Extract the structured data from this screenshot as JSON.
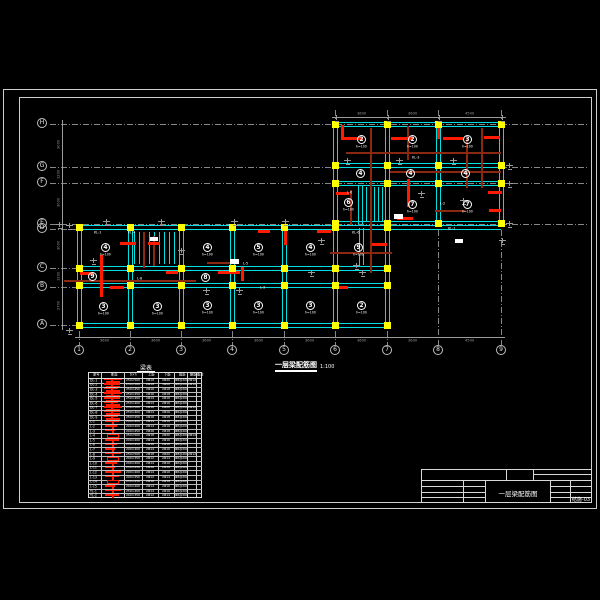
{
  "colors": {
    "cyan": "#00e0e0",
    "yellow": "#ffff00",
    "red": "#ff1a00",
    "maroon": "#8a2812",
    "gray": "#9a9a9a",
    "white": "#ffffff",
    "frame": "#cfcfcf"
  },
  "plan": {
    "title": {
      "text": "一层梁配筋图",
      "scale": "1:100"
    },
    "axes_x": [
      {
        "x": 79,
        "label": "1",
        "ext": 331
      },
      {
        "x": 130,
        "label": "2",
        "ext": 331
      },
      {
        "x": 181,
        "label": "3",
        "ext": 331
      },
      {
        "x": 232,
        "label": "4",
        "ext": 331
      },
      {
        "x": 284,
        "label": "5",
        "ext": 331
      },
      {
        "x": 335,
        "label": "6",
        "ext": 331
      },
      {
        "x": 387,
        "label": "7",
        "ext": 331
      },
      {
        "x": 438,
        "label": "8",
        "ext": 230
      },
      {
        "x": 501,
        "label": "9",
        "ext": 230
      }
    ],
    "axes_y": [
      {
        "y": 124,
        "label": "H",
        "x2": 588
      },
      {
        "y": 167,
        "label": "G",
        "x2": 588
      },
      {
        "y": 183,
        "label": "F",
        "x2": 588
      },
      {
        "y": 224,
        "label": "E",
        "x2": 588
      },
      {
        "y": 229,
        "label": "D",
        "x2": 340
      },
      {
        "y": 268,
        "label": "C",
        "x2": 82
      },
      {
        "y": 287,
        "label": "B",
        "x2": 82
      },
      {
        "y": 325,
        "label": "A",
        "x2": 82
      }
    ],
    "top_stubs": [
      [
        335,
        110,
        14
      ],
      [
        387,
        110,
        14
      ],
      [
        438,
        110,
        14
      ],
      [
        501,
        110,
        14
      ]
    ],
    "beams_h": [
      [
        335,
        124,
        166
      ],
      [
        335,
        165,
        166
      ],
      [
        335,
        183,
        166
      ],
      [
        335,
        223,
        166
      ],
      [
        79,
        227,
        422
      ],
      [
        79,
        268,
        309
      ],
      [
        79,
        285,
        309
      ],
      [
        79,
        325,
        309
      ]
    ],
    "beams_v": [
      [
        79,
        227,
        98
      ],
      [
        130,
        227,
        98
      ],
      [
        181,
        227,
        98
      ],
      [
        232,
        227,
        98
      ],
      [
        284,
        227,
        98
      ],
      [
        335,
        124,
        201
      ],
      [
        387,
        124,
        201
      ],
      [
        438,
        124,
        103
      ],
      [
        501,
        124,
        103
      ]
    ],
    "column_grids": [
      {
        "xs": [
          335,
          387,
          438,
          501
        ],
        "ys": [
          124,
          165,
          183,
          223
        ]
      },
      {
        "xs": [
          79,
          130,
          181,
          232,
          284,
          335,
          387
        ],
        "ys": [
          227,
          268,
          285,
          325
        ]
      }
    ],
    "stairs": [
      [
        357,
        185,
        30,
        "h"
      ],
      [
        358,
        186,
        38,
        "v"
      ],
      [
        362,
        186,
        38,
        "v"
      ],
      [
        366,
        187,
        35,
        "v"
      ],
      [
        370,
        187,
        35,
        "v"
      ],
      [
        374,
        187,
        35,
        "v"
      ],
      [
        378,
        187,
        35,
        "v"
      ],
      [
        382,
        187,
        35,
        "v"
      ],
      [
        359,
        228,
        37,
        "v"
      ],
      [
        363,
        228,
        37,
        "v"
      ],
      [
        134,
        232,
        32,
        "v"
      ],
      [
        139,
        232,
        32,
        "v"
      ],
      [
        144,
        232,
        32,
        "v"
      ],
      [
        149,
        232,
        32,
        "v"
      ],
      [
        154,
        232,
        32,
        "v"
      ],
      [
        159,
        232,
        32,
        "v"
      ],
      [
        164,
        232,
        32,
        "v"
      ],
      [
        169,
        232,
        32,
        "v"
      ],
      [
        174,
        232,
        32,
        "v"
      ]
    ],
    "maroon": [
      [
        346,
        152,
        155,
        "h"
      ],
      [
        390,
        171,
        111,
        "h"
      ],
      [
        330,
        252,
        62,
        "h"
      ],
      [
        64,
        280,
        132,
        "h"
      ],
      [
        207,
        262,
        30,
        "h"
      ],
      [
        435,
        210,
        30,
        "h"
      ],
      [
        370,
        128,
        145,
        "v"
      ],
      [
        407,
        126,
        34,
        "v"
      ],
      [
        466,
        138,
        50,
        "v"
      ],
      [
        350,
        190,
        35,
        "v"
      ],
      [
        481,
        128,
        60,
        "v"
      ],
      [
        143,
        232,
        36,
        "v"
      ],
      [
        153,
        236,
        30,
        "v"
      ]
    ],
    "red_marks": [
      [
        341,
        137,
        22,
        "h"
      ],
      [
        391,
        137,
        22,
        "h"
      ],
      [
        443,
        137,
        20,
        "h"
      ],
      [
        484,
        136,
        16,
        "h"
      ],
      [
        336,
        192,
        13,
        "h"
      ],
      [
        372,
        243,
        15,
        "h"
      ],
      [
        397,
        217,
        16,
        "h"
      ],
      [
        488,
        191,
        14,
        "h"
      ],
      [
        489,
        209,
        12,
        "h"
      ],
      [
        80,
        272,
        14,
        "h"
      ],
      [
        218,
        271,
        22,
        "h"
      ],
      [
        120,
        242,
        16,
        "h"
      ],
      [
        148,
        242,
        12,
        "h"
      ],
      [
        317,
        230,
        14,
        "h"
      ],
      [
        258,
        230,
        12,
        "h"
      ],
      [
        166,
        271,
        12,
        "h"
      ],
      [
        110,
        286,
        14,
        "h"
      ],
      [
        336,
        286,
        12,
        "h"
      ],
      [
        100,
        255,
        42,
        "v"
      ],
      [
        407,
        179,
        28,
        "v"
      ],
      [
        341,
        125,
        14,
        "v"
      ],
      [
        241,
        267,
        14,
        "v"
      ],
      [
        284,
        231,
        14,
        "v"
      ],
      [
        437,
        125,
        14,
        "v"
      ]
    ],
    "white_boxes": [
      [
        394,
        214,
        9,
        5
      ],
      [
        230,
        259,
        9,
        5
      ],
      [
        455,
        239,
        8,
        4
      ],
      [
        150,
        237,
        8,
        4
      ]
    ],
    "slab_labels": [
      {
        "x": 361,
        "y": 139,
        "num": "2",
        "sub": "h=100"
      },
      {
        "x": 412,
        "y": 139,
        "num": "2",
        "sub": "h=100"
      },
      {
        "x": 467,
        "y": 139,
        "num": "3",
        "sub": "h=100"
      },
      {
        "x": 360,
        "y": 173,
        "num": "4",
        "sub": ""
      },
      {
        "x": 410,
        "y": 173,
        "num": "4",
        "sub": ""
      },
      {
        "x": 465,
        "y": 173,
        "num": "4",
        "sub": ""
      },
      {
        "x": 348,
        "y": 202,
        "num": "6",
        "sub": "h=100"
      },
      {
        "x": 412,
        "y": 204,
        "num": "7",
        "sub": "h=100"
      },
      {
        "x": 467,
        "y": 204,
        "num": "7",
        "sub": "h=100"
      },
      {
        "x": 105,
        "y": 247,
        "num": "4",
        "sub": "h=100"
      },
      {
        "x": 207,
        "y": 247,
        "num": "4",
        "sub": "h=100"
      },
      {
        "x": 258,
        "y": 247,
        "num": "5",
        "sub": "h=100"
      },
      {
        "x": 310,
        "y": 247,
        "num": "4",
        "sub": "h=100"
      },
      {
        "x": 358,
        "y": 247,
        "num": "9",
        "sub": "h=100"
      },
      {
        "x": 92,
        "y": 276,
        "num": "9",
        "sub": ""
      },
      {
        "x": 205,
        "y": 277,
        "num": "8",
        "sub": ""
      },
      {
        "x": 103,
        "y": 306,
        "num": "3",
        "sub": "h=100"
      },
      {
        "x": 157,
        "y": 306,
        "num": "3",
        "sub": "h=100"
      },
      {
        "x": 207,
        "y": 305,
        "num": "3",
        "sub": "h=100"
      },
      {
        "x": 258,
        "y": 305,
        "num": "3",
        "sub": "h=100"
      },
      {
        "x": 310,
        "y": 305,
        "num": "3",
        "sub": "h=100"
      },
      {
        "x": 361,
        "y": 305,
        "num": "2",
        "sub": "h=100"
      }
    ],
    "beam_texts": [
      [
        137,
        277,
        "L-8"
      ],
      [
        243,
        262,
        "L-5"
      ],
      [
        352,
        231,
        "KL-6"
      ],
      [
        347,
        191,
        "L-6"
      ],
      [
        412,
        156,
        "KL-3"
      ],
      [
        448,
        227,
        "KL-1"
      ],
      [
        128,
        231,
        "KL-4"
      ],
      [
        260,
        286,
        "L-3"
      ],
      [
        440,
        202,
        "L-2"
      ],
      [
        94,
        231,
        "KL-1"
      ]
    ],
    "annos": [
      [
        333,
        115
      ],
      [
        385,
        115
      ],
      [
        436,
        115
      ],
      [
        499,
        115
      ],
      [
        506,
        163
      ],
      [
        506,
        181
      ],
      [
        506,
        221
      ],
      [
        344,
        158
      ],
      [
        396,
        158
      ],
      [
        450,
        158
      ],
      [
        231,
        219
      ],
      [
        158,
        219
      ],
      [
        103,
        219
      ],
      [
        282,
        219
      ],
      [
        56,
        222
      ],
      [
        318,
        238
      ],
      [
        203,
        288
      ],
      [
        460,
        198
      ],
      [
        90,
        258
      ],
      [
        236,
        288
      ],
      [
        308,
        270
      ],
      [
        359,
        270
      ],
      [
        418,
        191
      ],
      [
        353,
        263
      ],
      [
        178,
        248
      ],
      [
        66,
        328
      ],
      [
        66,
        223
      ],
      [
        499,
        238
      ]
    ],
    "dims": {
      "bottom": {
        "y": 337,
        "x1": 75,
        "x2": 505,
        "labels": [
          [
            104,
            "3600"
          ],
          [
            155,
            "3600"
          ],
          [
            206,
            "3600"
          ],
          [
            258,
            "3600"
          ],
          [
            309,
            "3600"
          ],
          [
            361,
            "3600"
          ],
          [
            412,
            "3600"
          ],
          [
            469,
            "4500"
          ]
        ]
      },
      "top": {
        "y": 117,
        "x1": 332,
        "x2": 504,
        "labels": [
          [
            361,
            "3600"
          ],
          [
            412,
            "3600"
          ],
          [
            469,
            "4500"
          ]
        ]
      },
      "left": {
        "x": 62,
        "y1": 120,
        "y2": 330,
        "labels": [
          [
            145,
            "3000"
          ],
          [
            175,
            "1200"
          ],
          [
            203,
            "3000"
          ],
          [
            246,
            "3000"
          ],
          [
            277,
            "1200"
          ],
          [
            306,
            "2700"
          ]
        ]
      }
    }
  },
  "schedule": {
    "title": "梁表",
    "x": 88,
    "y": 372,
    "w": 114,
    "h": 126,
    "header_h": 6,
    "col_edges": [
      0,
      13,
      36,
      54,
      70,
      86,
      99,
      108,
      114
    ],
    "header": [
      "梁号",
      "断面",
      "b×h",
      "上筋",
      "下筋",
      "箍筋",
      "腰筋",
      "备注"
    ],
    "rows": [
      [
        "DL-1",
        "250×500",
        "2Φ18",
        "2Φ20",
        "Φ8@200",
        "2Φ12",
        ""
      ],
      [
        "DL-2",
        "250×500",
        "2Φ18",
        "3Φ20",
        "Φ8@200",
        "2Φ12",
        ""
      ],
      [
        "DL-3",
        "250×450",
        "2Φ16",
        "2Φ18",
        "Φ8@200",
        "",
        ""
      ],
      [
        "DL-4",
        "250×450",
        "2Φ16",
        "2Φ18",
        "Φ8@200",
        "",
        ""
      ],
      [
        "DL-5",
        "250×400",
        "2Φ14",
        "2Φ16",
        "Φ6@200",
        "",
        ""
      ],
      [
        "DL-6",
        "250×400",
        "2Φ14",
        "2Φ16",
        "Φ6@200",
        "",
        ""
      ],
      [
        "DL-7",
        "250×500",
        "2Φ18",
        "2Φ20",
        "Φ8@200",
        "2Φ12",
        ""
      ],
      [
        "DL-8",
        "250×400",
        "2Φ14",
        "2Φ16",
        "Φ6@200",
        "",
        ""
      ],
      [
        "DL-9",
        "250×450",
        "2Φ16",
        "2Φ18",
        "Φ8@200",
        "",
        ""
      ],
      [
        "L-1",
        "200×400",
        "2Φ14",
        "2Φ16",
        "Φ6@200",
        "",
        ""
      ],
      [
        "L-2",
        "200×400",
        "2Φ14",
        "2Φ16",
        "Φ6@200",
        "",
        ""
      ],
      [
        "L-3",
        "200×450",
        "2Φ16",
        "2Φ18",
        "Φ8@200",
        "",
        ""
      ],
      [
        "L-4",
        "250×500",
        "2Φ18",
        "2Φ20",
        "Φ8@200",
        "2Φ12",
        ""
      ],
      [
        "L-5",
        "200×400",
        "2Φ14",
        "2Φ16",
        "Φ6@200",
        "",
        ""
      ],
      [
        "L-6",
        "250×450",
        "2Φ16",
        "2Φ18",
        "Φ8@200",
        "",
        ""
      ],
      [
        "L-7",
        "200×400",
        "2Φ14",
        "2Φ16",
        "Φ6@200",
        "",
        ""
      ],
      [
        "L-8",
        "250×500",
        "2Φ18",
        "2Φ20",
        "Φ8@200",
        "2Φ12",
        ""
      ],
      [
        "L-9",
        "200×350",
        "2Φ12",
        "2Φ14",
        "Φ6@200",
        "",
        ""
      ],
      [
        "L-10",
        "200×400",
        "2Φ14",
        "2Φ16",
        "Φ6@200",
        "",
        ""
      ],
      [
        "L-11",
        "250×450",
        "2Φ16",
        "2Φ18",
        "Φ8@200",
        "",
        ""
      ],
      [
        "L-12",
        "200×400",
        "2Φ14",
        "2Φ16",
        "Φ6@200",
        "",
        ""
      ],
      [
        "L-13",
        "200×350",
        "2Φ12",
        "2Φ14",
        "Φ6@200",
        "",
        ""
      ],
      [
        "L-14",
        "250×450",
        "2Φ16",
        "2Φ18",
        "Φ8@200",
        "",
        ""
      ],
      [
        "L-15",
        "200×400",
        "2Φ14",
        "2Φ16",
        "Φ6@200",
        "",
        ""
      ],
      [
        "TL-1",
        "250×400",
        "2Φ14",
        "2Φ16",
        "Φ6@200",
        "",
        ""
      ],
      [
        "TL-2",
        "200×350",
        "2Φ12",
        "2Φ14",
        "Φ6@200",
        "",
        ""
      ]
    ]
  },
  "title_block": {
    "title": "一层梁配筋图",
    "drawing_no": "结施-03"
  }
}
